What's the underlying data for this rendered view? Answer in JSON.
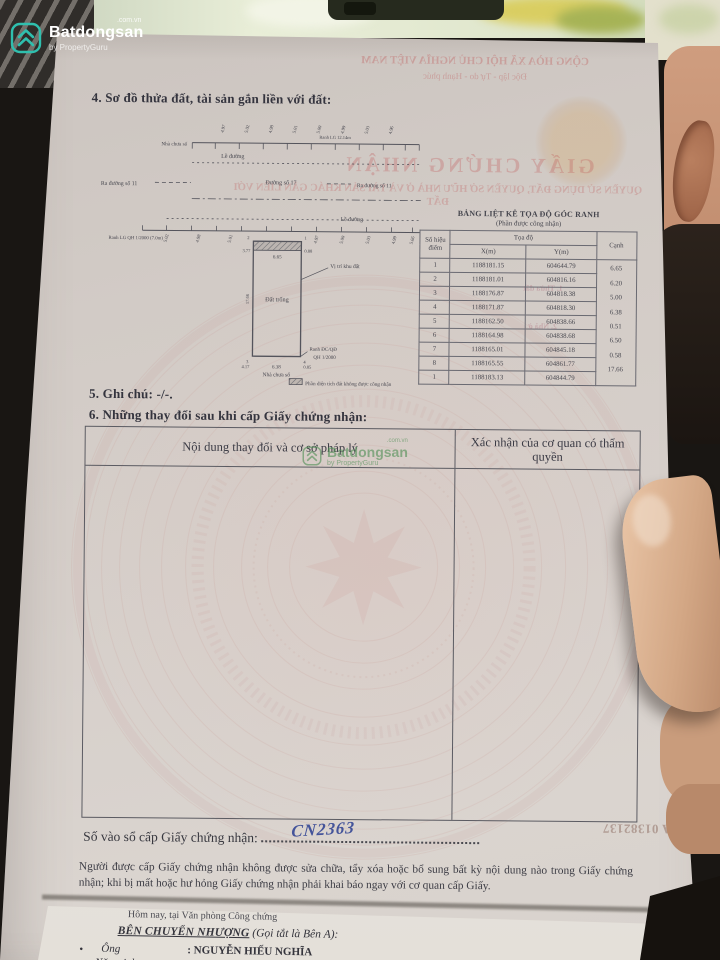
{
  "colors": {
    "accent_teal": "#2fbfae",
    "paper": "#d2cbc6",
    "ink": "#3b3b45",
    "red_bleed": "#c05a5a",
    "handwriting_ink": "#44549a",
    "watermark_green": "#5f9e63"
  },
  "brand": {
    "name": "Batdongsan",
    "domain": ".com.vn",
    "byline": "by PropertyGuru"
  },
  "cert": {
    "section4_title": "4. Sơ đồ thửa đất, tài sản gắn liền với đất:",
    "diagram": {
      "house_top": "Nhà chưa số",
      "curb_top": "Lề đường",
      "curb_bottom": "Lề đường",
      "street_left": "Ra đường số 11",
      "street_center": "Đường số 17",
      "street_right": "Ra đường số 11",
      "ranh_top": "Ranh LG 12.14m",
      "ranh_lg": "Ranh LG QH 1/2000 (7.0m)",
      "empty_land": "Đất trống",
      "location": "Vị trí khu đất",
      "ranh_qd": "Ranh ĐC/QĐ",
      "qh": "QH 1/2000",
      "house_bottom": "Nhà chưa số",
      "dim_top": "6.65",
      "dim_bottom": "6.38",
      "dim_left": "17.66",
      "dim_tl": "3.77",
      "dim_tr": "0.88",
      "dim_bl": "4.17",
      "dim_br": "0.85",
      "corner_tl": "2",
      "corner_tr": "1",
      "corner_bl": "3",
      "corner_br": "4",
      "ticks_top": [
        "4.97",
        "5.02",
        "4.98",
        "5.01",
        "5.00",
        "4.99",
        "5.03",
        "4.96"
      ],
      "ticks_bottom": [
        "5.02",
        "4.98",
        "5.01",
        "4.97",
        "5.00",
        "5.03",
        "4.99",
        "5.66"
      ],
      "legend": "Phần diện tích đất không được công nhận"
    },
    "coord_table": {
      "title": "BẢNG LIỆT KÊ TỌA ĐỘ GÓC RANH",
      "subtitle": "(Phần được công nhận)",
      "col_point": "Số hiệu điểm",
      "col_coord": "Tọa độ",
      "col_x": "X(m)",
      "col_y": "Y(m)",
      "col_edge": "Cạnh",
      "rows": [
        {
          "p": "1",
          "x": "1188181.15",
          "y": "604644.79"
        },
        {
          "p": "2",
          "x": "1188181.01",
          "y": "604816.16"
        },
        {
          "p": "3",
          "x": "1188176.87",
          "y": "604818.38"
        },
        {
          "p": "4",
          "x": "1188171.87",
          "y": "604818.30"
        },
        {
          "p": "5",
          "x": "1188162.50",
          "y": "604838.66"
        },
        {
          "p": "6",
          "x": "1188164.98",
          "y": "604838.68"
        },
        {
          "p": "7",
          "x": "1188165.01",
          "y": "604845.18"
        },
        {
          "p": "8",
          "x": "1188165.55",
          "y": "604861.77"
        },
        {
          "p": "1",
          "x": "1188183.13",
          "y": "604844.79"
        }
      ],
      "edges": [
        "6.65",
        "6.20",
        "5.00",
        "6.38",
        "0.51",
        "6.50",
        "0.58",
        "17.66"
      ]
    },
    "section5_title": "5. Ghi chú: -/-.",
    "section6_title": "6. Những thay đổi sau khi cấp Giấy chứng nhận:",
    "changes_table": {
      "col_content": "Nội dung thay đổi và cơ sở pháp lý",
      "col_confirm": "Xác nhận của cơ quan có thẩm quyền"
    },
    "registry_label": "Số vào sổ cấp Giấy chứng nhận:",
    "registry_value": "CN2363",
    "serial": "AA 01382137",
    "notice_line": "Người được cấp Giấy chứng nhận không được sửa chữa, tẩy xóa hoặc bổ sung bất kỳ nội dung nào trong Giấy chứng nhận; khi bị mất hoặc hư hỏng Giấy chứng nhận phải khai báo ngay với cơ quan cấp Giấy.",
    "bleed": {
      "l1": "CỘNG HÒA XÃ HỘI CHỦ NGHĨA VIỆT NAM",
      "l2": "Độc lập - Tự do - Hạnh phúc",
      "l3": "GIẤY CHỨNG NHẬN",
      "l4": "QUYỀN SỬ DỤNG ĐẤT, QUYỀN SỞ HỮU NHÀ Ở VÀ TÀI SẢN KHÁC GẮN LIỀN VỚI ĐẤT",
      "l5": "1. Thửa đất",
      "l6": "2. Nhà ở"
    }
  },
  "contract": {
    "intro": "Hôm nay, tại Văn phòng Công chứng",
    "party": "BÊN CHUYỂN NHƯỢNG",
    "party_suffix": "(Gọi tắt là Bên A):",
    "row1_label": "Ông",
    "row1_value": ": NGUYỄN HIẾU NGHĨA",
    "row2_label": "Năm sinh",
    "row2_value": ": 1985"
  }
}
